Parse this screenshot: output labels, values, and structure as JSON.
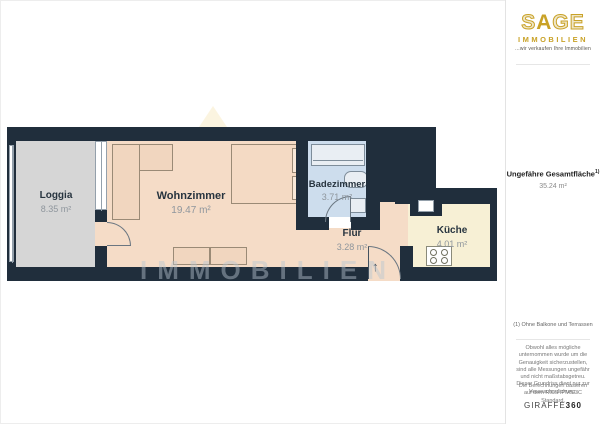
{
  "header_logo": {
    "brand_s": "S",
    "brand_a": "A",
    "brand_ge": "GE",
    "subtitle": "IMMOBILIEN",
    "tagline": "...wir verkaufen Ihre Immobilien",
    "gold_color": "#c9a227"
  },
  "sidebar": {
    "total_area_label": "Ungefähre Gesamtfläche",
    "total_area_marker": "1)",
    "total_area_value": "35.24 m²",
    "footnote": "(1) Ohne Balkone und Terrassen",
    "disclaimer": "Obwohl alles mögliche unternommen wurde um die Genauigkeit sicherzustellen, sind alle Messungen ungefähr und nicht maßstabsgetreu. Dieser Grundriss dient nur zur Veranschaulichung.",
    "standard_note": "Die Berechnungen basieren auf dem RICS IPMS 3C Standard.",
    "footer_brand_regular": "GIRAFFE",
    "footer_brand_bold": "360"
  },
  "floorplan": {
    "watermark_text": "IMMOBILIEN",
    "entrance_arrow": "↑",
    "wall_color": "#202e3c",
    "rooms": [
      {
        "name": "Loggia",
        "area": "8.35 m²",
        "floor_color": "#d6d6d6"
      },
      {
        "name": "Wohnzimmer",
        "area": "19.47 m²",
        "floor_color": "#f5dcc7"
      },
      {
        "name": "Badezimmer",
        "area": "3.71 m²",
        "floor_color": "#cddded"
      },
      {
        "name": "Flur",
        "area": "3.28 m²",
        "floor_color": "#f5dcc7"
      },
      {
        "name": "Küche",
        "area": "4.01 m²",
        "floor_color": "#f7f0d5"
      }
    ]
  }
}
